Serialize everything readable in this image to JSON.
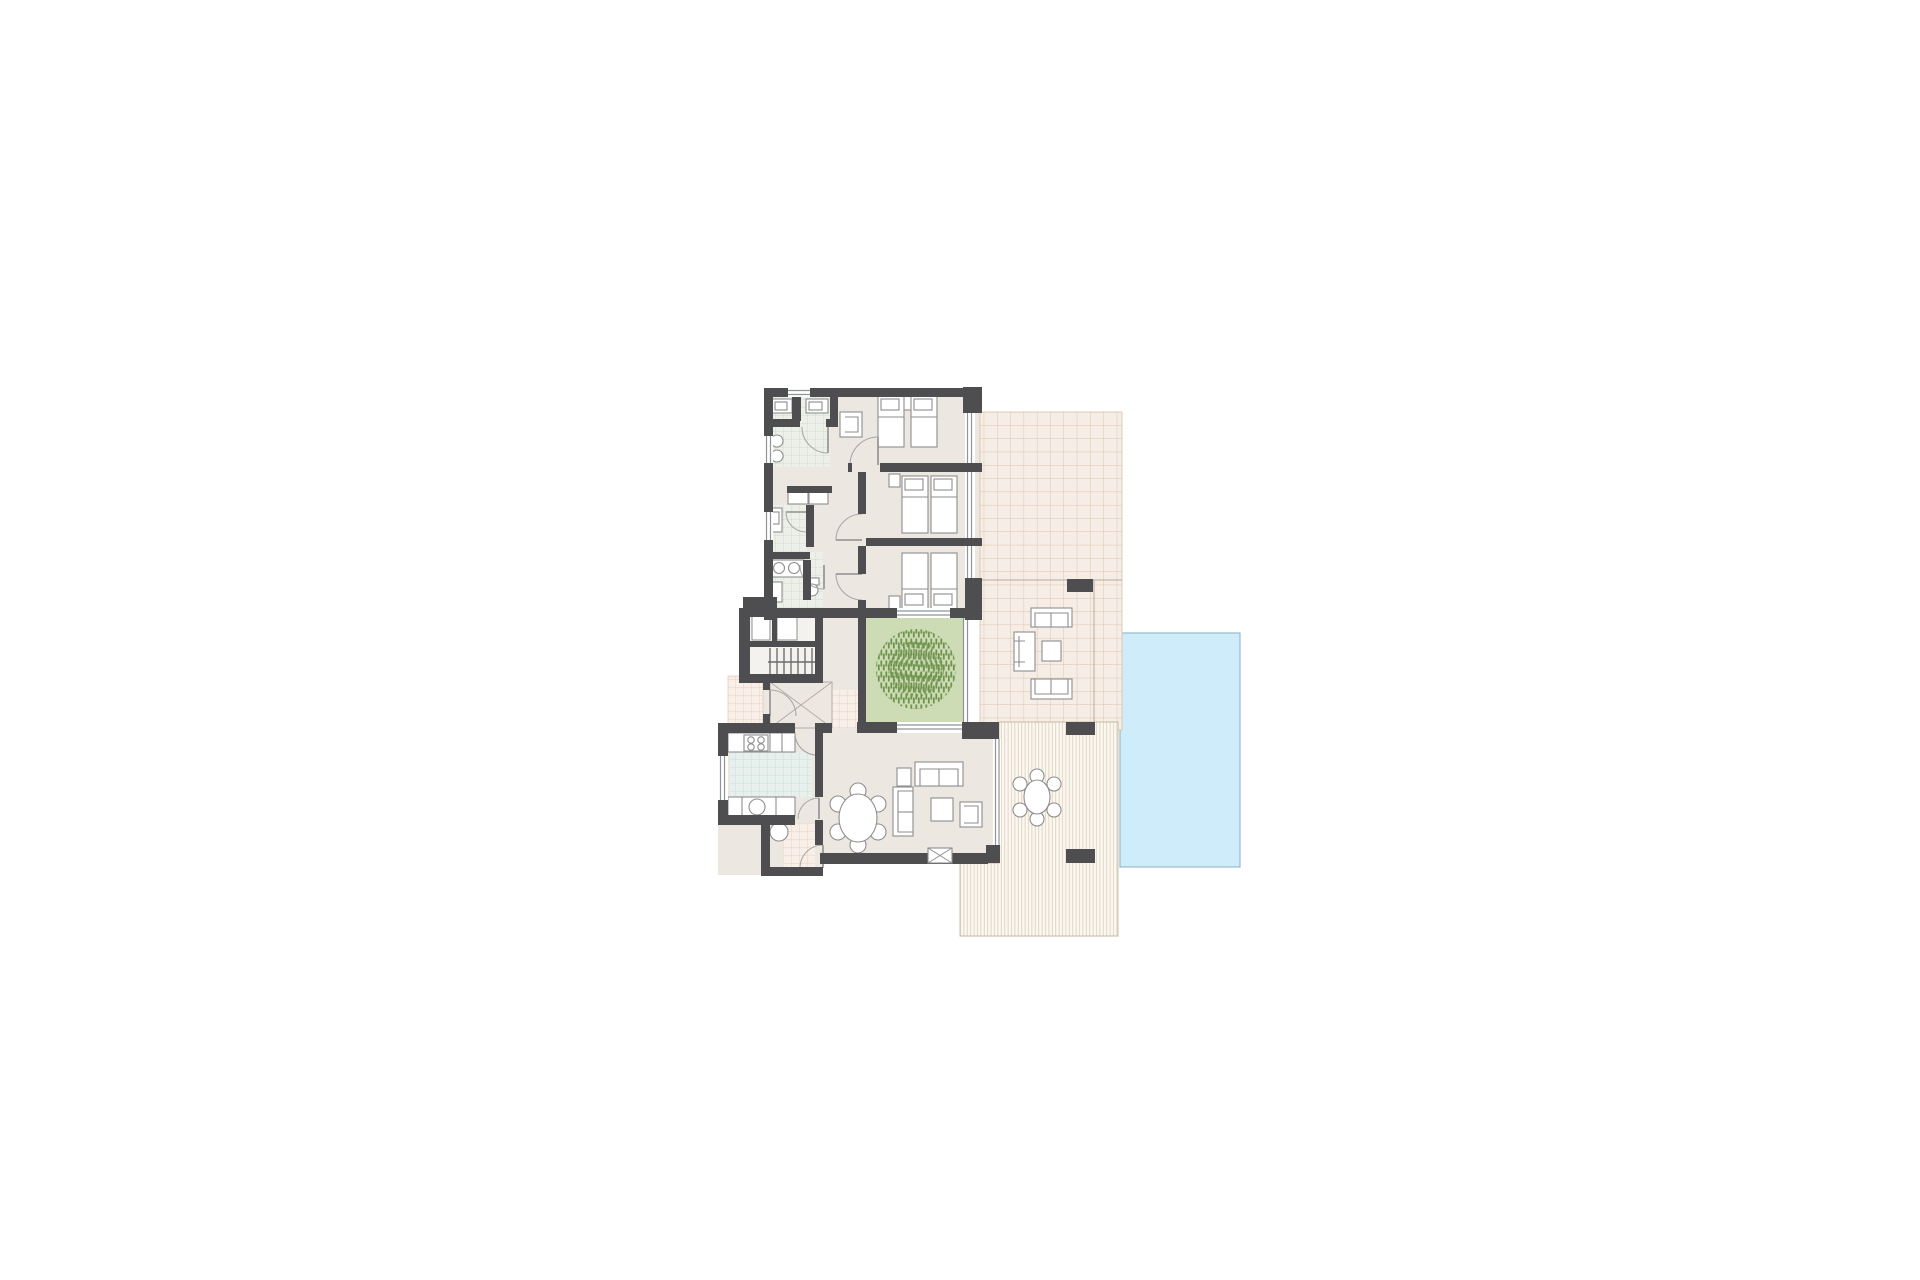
{
  "meta": {
    "type": "architectural-floor-plan",
    "view": "top-down",
    "background": "#ffffff"
  },
  "rooms": [
    {
      "id": "bedroom-1",
      "beds": 2
    },
    {
      "id": "bedroom-2",
      "beds": 2
    },
    {
      "id": "bedroom-3",
      "beds": 2
    },
    {
      "id": "bathroom-1",
      "fixtures": "double-vanity, wc, bidet"
    },
    {
      "id": "bathroom-2",
      "fixtures": "vanity"
    },
    {
      "id": "bathroom-3",
      "fixtures": "double-sink, wc"
    },
    {
      "id": "hallway",
      "feature": "wardrobe-closets"
    },
    {
      "id": "staircase",
      "treads": 8
    },
    {
      "id": "entry-hall",
      "feature": "x-marked-floor"
    },
    {
      "id": "entry-patio",
      "finish": "tiled"
    },
    {
      "id": "kitchen",
      "fixtures": "4-burner-hob, sink"
    },
    {
      "id": "utility-room",
      "fixtures": "appliance"
    },
    {
      "id": "living-dining-room",
      "furniture": "sofa-set, coffee-table, fireplace, round-dining-table-6-chairs"
    },
    {
      "id": "courtyard",
      "feature": "tree"
    },
    {
      "id": "terrace",
      "finish": "tiled",
      "furniture": "2 outdoor sofas, armchair, coffee-table"
    },
    {
      "id": "covered-deck",
      "finish": "wood-decking",
      "furniture": "round-table-6-chairs"
    },
    {
      "id": "pool",
      "shape": "rectangle"
    }
  ],
  "counts": {
    "bedrooms": 3,
    "single_beds": 6,
    "dining_chairs_inside": 6,
    "deck_chairs_outside": 6,
    "door_swings": 10
  },
  "colors": {
    "wall": "#4e4e50",
    "floor": "#ece7e1",
    "stair_floor": "#f4f2ef",
    "bath_bg": "#edf0e9",
    "bath_line": "#c9d4c4",
    "kitchen_bg": "#e7f0ec",
    "kitchen_line": "#c2dcd3",
    "terrace_bg": "#f6eee6",
    "terrace_line": "#dcc3a8",
    "patio_bg": "#f8efe9",
    "patio_line": "#e4c9b6",
    "courtyard": "#cddcb5",
    "tree": "#6f934e",
    "pool": "#cfecfa",
    "pool_edge": "#94bccb",
    "deck_bg": "#fcf8f1",
    "deck_line": "#d9cdb9",
    "deck_edge": "#c3b6a0",
    "furniture": "#8e8e8e"
  }
}
